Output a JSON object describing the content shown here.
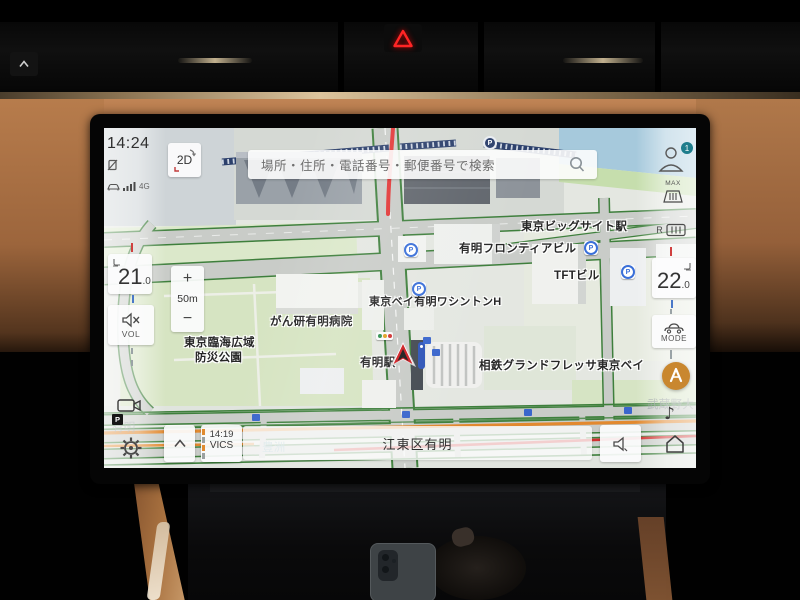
{
  "screen": {
    "statusbar": {
      "time": "14:24",
      "network": "4G"
    },
    "view_button": "2D",
    "search": {
      "placeholder": "場所・住所・電話番号・郵便番号で検索"
    },
    "zoom_control": {
      "zoom_in": "+",
      "scale": "50m",
      "zoom_out": "−"
    },
    "climate": {
      "left_temp": "21",
      "left_temp_decimal": ".0",
      "right_temp": "22",
      "right_temp_decimal": ".0"
    },
    "left_rail": {
      "volume_label": "VOL",
      "camera_badge": "P"
    },
    "right_rail": {
      "profile_badge": "1",
      "defrost_max_label": "MAX",
      "defrost_rear_label": "R",
      "drive_mode_label": "MODE"
    },
    "icons": {
      "music_note": "♪"
    },
    "bottom_bar": {
      "vics_time": "14:19",
      "vics_label": "VICS",
      "location": "江東区有明"
    },
    "map_labels": {
      "big_sight_station": "東京ビッグサイト駅",
      "frontier_building": "有明フロンティアビル",
      "tft_building": "TFTビル",
      "washington_hotel": "東京ベイ有明ワシントンH",
      "cancer_institute_hospital": "がん研有明病院",
      "rinkai_park_line1": "東京臨海広域",
      "rinkai_park_line2": "防災公園",
      "ariake_station": "有明駅",
      "sotetsu_grand_fresa": "相鉄グランドフレッサ東京ベイ",
      "toyosu": "豊洲",
      "musashino_univ": "武蔵野大",
      "ariake_area": "有明",
      "parking": "P"
    },
    "colors": {
      "accent_orange": "#c9872f",
      "badge_teal": "#1e7d8c",
      "hazard_red": "#e11b22",
      "route_red": "#e23535",
      "congestion_green": "#3e7f3c",
      "congestion_orange": "#e2892f",
      "congestion_red": "#d23131",
      "water_blue": "#a6c9dc"
    }
  }
}
